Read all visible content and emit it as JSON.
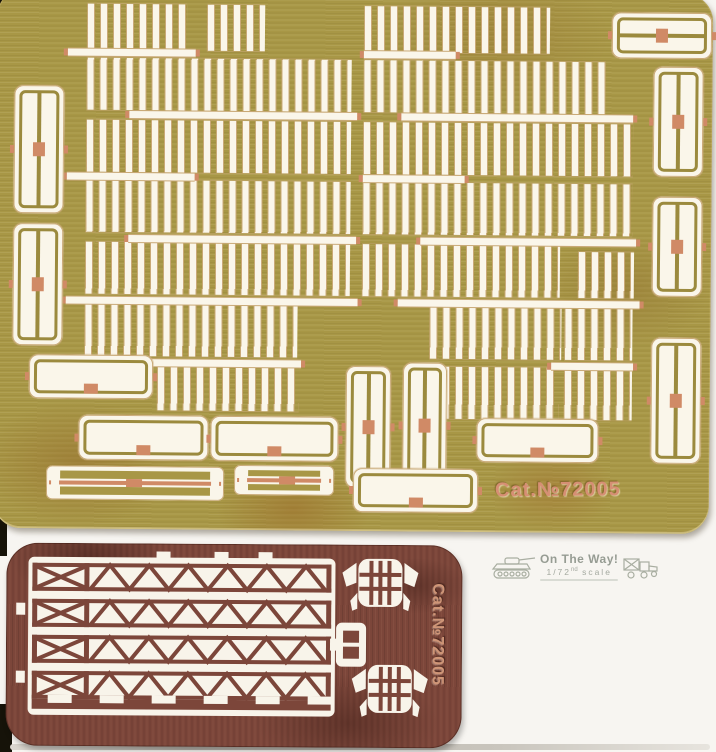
{
  "scan": {
    "background": "#f7f5f1",
    "corner_shadow_color": "#161309",
    "bottom_edge_color": "#c6c2ba"
  },
  "brass_sheet": {
    "label": "Cat.№72005",
    "label_color": "#d68f74",
    "base_color": "#a89746",
    "cutout_color": "#faf6ea",
    "comb_rows": [
      [
        85,
        6,
        100,
        46
      ],
      [
        205,
        6,
        58,
        46
      ],
      [
        85,
        60,
        265,
        52
      ],
      [
        85,
        122,
        265,
        52
      ],
      [
        85,
        182,
        265,
        52
      ],
      [
        85,
        244,
        265,
        52
      ],
      [
        85,
        306,
        213,
        52
      ],
      [
        158,
        366,
        142,
        46
      ],
      [
        362,
        6,
        186,
        46
      ],
      [
        362,
        60,
        242,
        52
      ],
      [
        362,
        122,
        270,
        52
      ],
      [
        362,
        182,
        270,
        52
      ],
      [
        362,
        244,
        198,
        52
      ],
      [
        578,
        250,
        56,
        46
      ],
      [
        430,
        306,
        132,
        52
      ],
      [
        565,
        306,
        68,
        52
      ],
      [
        430,
        366,
        130,
        52
      ],
      [
        565,
        366,
        68,
        52
      ]
    ],
    "spines": [
      [
        66,
        51,
        128
      ],
      [
        128,
        113,
        228
      ],
      [
        66,
        175,
        128
      ],
      [
        128,
        237,
        228
      ],
      [
        66,
        299,
        292
      ],
      [
        140,
        361,
        162
      ],
      [
        362,
        51,
        92
      ],
      [
        400,
        113,
        232
      ],
      [
        362,
        175,
        102
      ],
      [
        420,
        237,
        216
      ],
      [
        398,
        299,
        242
      ],
      [
        552,
        361,
        82
      ]
    ],
    "v_frames": [
      [
        13,
        88,
        50,
        128
      ],
      [
        13,
        226,
        50,
        122
      ],
      [
        347,
        366,
        45,
        122
      ],
      [
        404,
        362,
        44,
        126
      ],
      [
        652,
        64,
        50,
        110
      ],
      [
        652,
        194,
        50,
        100
      ],
      [
        652,
        335,
        50,
        126
      ]
    ],
    "h_frames": [
      [
        610,
        10,
        100,
        46,
        "h"
      ],
      [
        30,
        357,
        124,
        44,
        ""
      ],
      [
        80,
        417,
        130,
        45,
        ""
      ],
      [
        212,
        417,
        128,
        45,
        ""
      ],
      [
        478,
        417,
        122,
        44,
        ""
      ],
      [
        355,
        468,
        125,
        44,
        ""
      ]
    ],
    "rods": [
      [
        48,
        468,
        178,
        34
      ],
      [
        236,
        466,
        100,
        30
      ]
    ]
  },
  "copper_sheet": {
    "label": "Cat.№72005",
    "label_color": "#cf9577",
    "base_color": "#7c463a",
    "cutout_color": "#f8f4ea",
    "truss_rows": 4,
    "grille_centers": [
      [
        374,
        40
      ],
      [
        384,
        146
      ]
    ],
    "bracket_pos": [
      330,
      72
    ]
  },
  "logo": {
    "title": "On The Way!",
    "scale_fraction": "1/72",
    "scale_ordinal": "nd",
    "scale_word": "scale",
    "text_color": "#868d83"
  }
}
